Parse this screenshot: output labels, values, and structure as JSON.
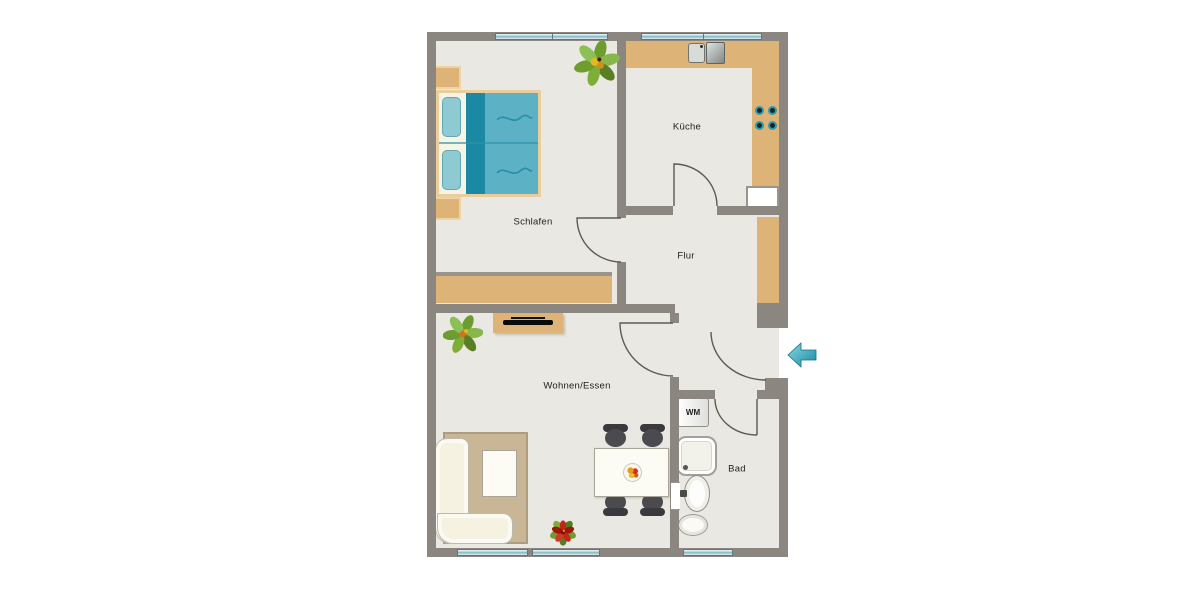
{
  "floorplan": {
    "rooms": {
      "schlafen": {
        "label": "Schlafen"
      },
      "kueche": {
        "label": "Küche"
      },
      "flur": {
        "label": "Flur"
      },
      "wohnen_essen": {
        "label": "Wohnen/Essen"
      },
      "bad": {
        "label": "Bad"
      }
    },
    "labels": {
      "washing_machine": "WM"
    },
    "colors": {
      "wall": "#8B8680",
      "floor": "#EAE8E2",
      "wood": "#DEB377",
      "wood_light": "#EACD9C",
      "bed_duvet": "#5CB2C4",
      "bed_stripe": "#1B89A4",
      "bed_pillow": "#8FCAD3",
      "window_glass": "#9CC8D2",
      "window_glass_light": "#E6F2F4",
      "rug": "#C8B697",
      "chair": "#3A3A3E",
      "door_line": "#5D5A55",
      "entry_arrow": "#1E9DB3"
    }
  }
}
